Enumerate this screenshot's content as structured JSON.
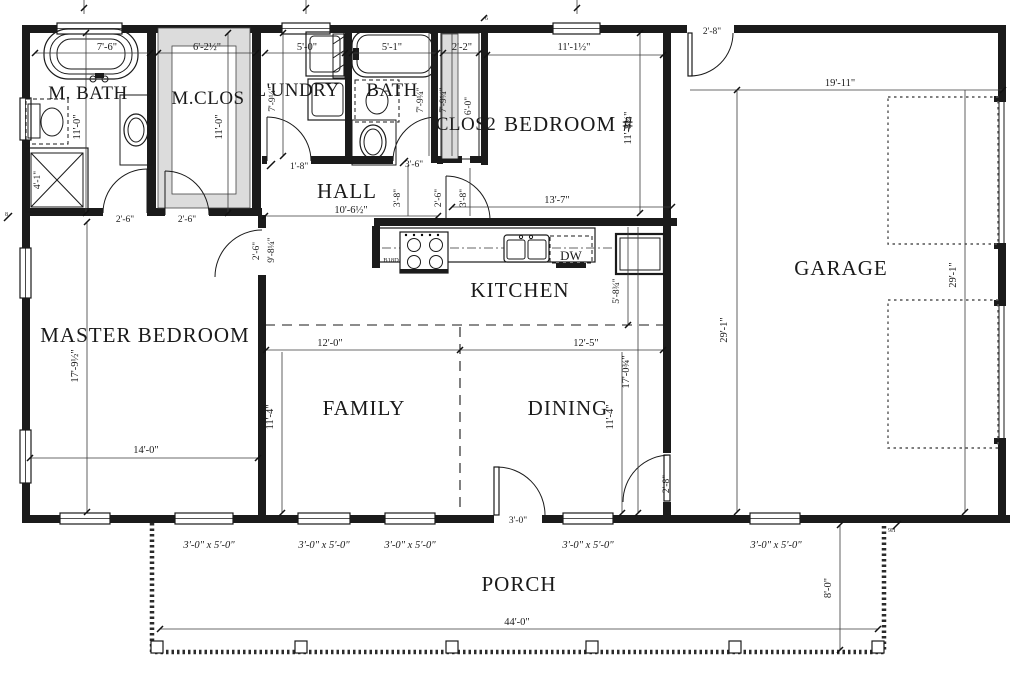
{
  "rooms": {
    "m_bath": "M. BATH",
    "m_clos": "M.CLOS",
    "laundry": "L'UNDRY",
    "bath": "BATH",
    "clos2": "CLOS2",
    "bedroom": "BEDROOM #",
    "hall": "HALL",
    "kitchen": "KITCHEN",
    "master": "MASTER BEDROOM",
    "family": "FAMILY",
    "dining": "DINING",
    "garage": "GARAGE",
    "porch": "PORCH"
  },
  "dims": {
    "d7_6": "7'-6\"",
    "d6_2h": "6'-2½\"",
    "d5_0": "5'-0\"",
    "d5_1": "5'-1\"",
    "d2_2": "2'-2\"",
    "d11_1h": "11'-1½\"",
    "d2_8": "2'-8\"",
    "d19_11": "19'-11\"",
    "d11_0": "11'-0\"",
    "d4_1": "4'-1\"",
    "d7_9q": "7'-9¼\"",
    "d6_0": "6'-0\"",
    "d11_8t": "11'-8¾\"",
    "d2_6": "2'-6\"",
    "d1_8": "1'-8\"",
    "d10_6h": "10'-6½\"",
    "d13_7": "13'-7\"",
    "d3_6": "3'-6\"",
    "d3_8": "3'-8\"",
    "d9_8q": "9'-8¼\"",
    "d5_8t": "5'-8¾\"",
    "d17_9h": "17'-9½\"",
    "d14_0": "14'-0\"",
    "d12_0": "12'-0\"",
    "d12_5": "12'-5\"",
    "d11_4": "11'-4\"",
    "d17_0t": "17'-0¾\"",
    "d29_1": "29'-1\"",
    "d3_0": "3'-0\"",
    "d44_0": "44'-0\"",
    "d8_0": "8'-0\""
  },
  "labels": {
    "dw": "DW",
    "b18d": "B18D",
    "wall_note": "2X6 WALL",
    "window_size": "3'-0\" x 5'-0\""
  },
  "marks": {
    "m1": "6",
    "m2": "8",
    "m3": "9H"
  }
}
